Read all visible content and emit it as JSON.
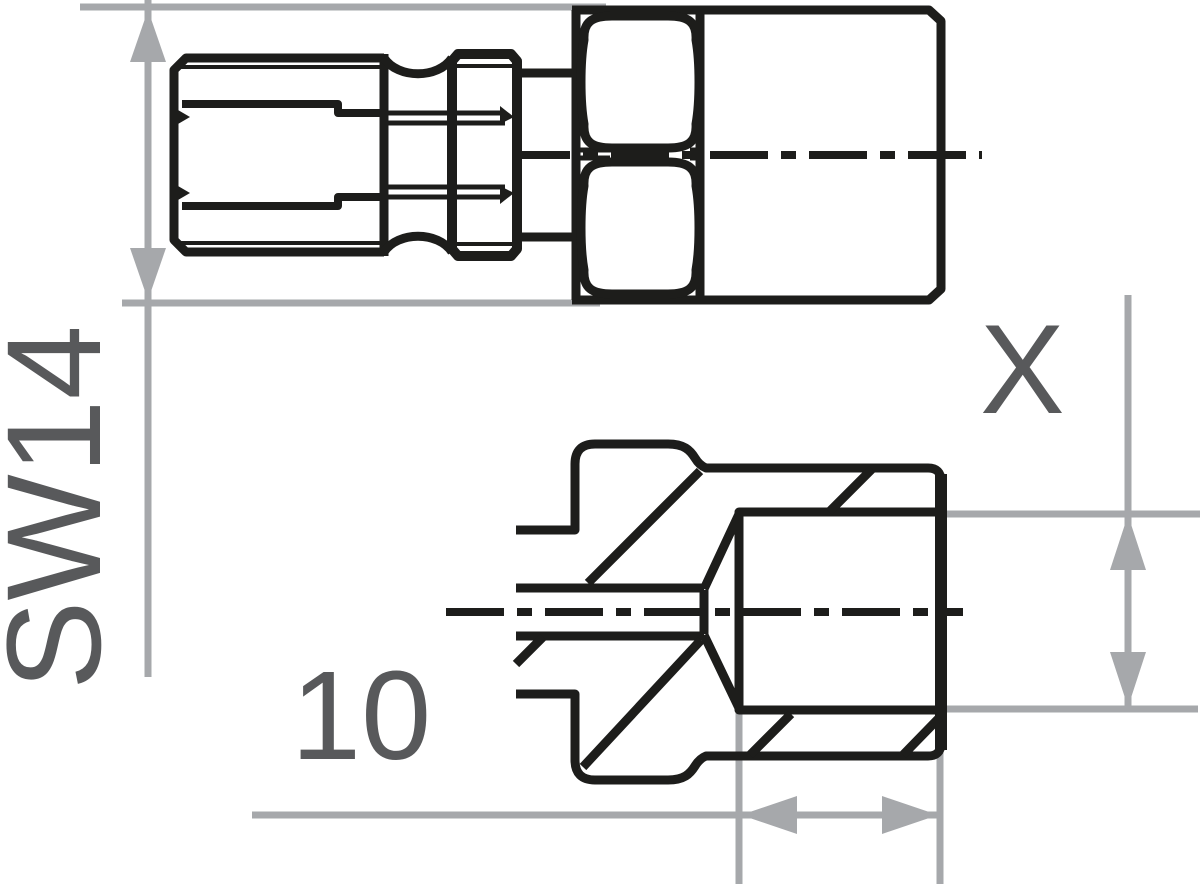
{
  "drawing": {
    "labels": {
      "hex_width": "SW14",
      "thread_length": "10",
      "seat_dimension": "X"
    },
    "colors": {
      "outline": "#1d1d1b",
      "dimension": "#a6a8ab",
      "label": "#58595b",
      "background": "#ffffff"
    }
  }
}
